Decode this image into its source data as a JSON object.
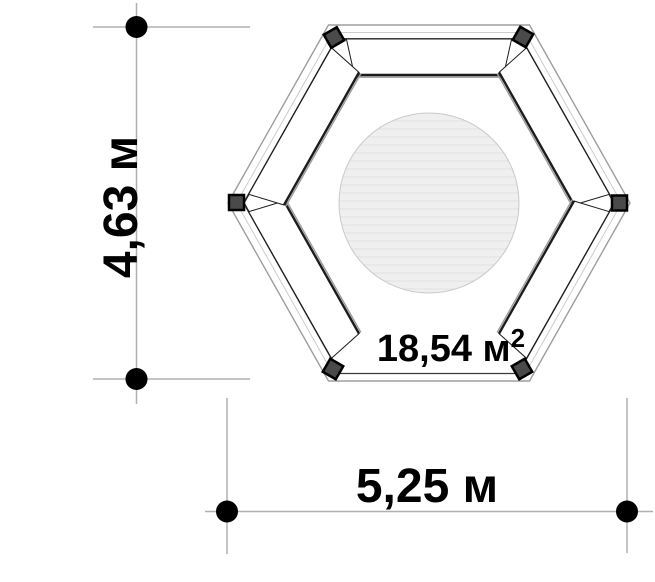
{
  "plan": {
    "dimensions": {
      "vertical": "4,63 м",
      "horizontal": "5,25 м"
    },
    "area": {
      "label": "18,54 м²",
      "base": "18,54 м",
      "superscript": "2"
    }
  },
  "colors": {
    "background": "#ffffff",
    "text": "#000000",
    "dim_line": "#b0b0b0",
    "dim_dot": "#000000",
    "wall_outer": "#9e9e9e",
    "wall_mid": "#cccccc",
    "wall_bottom": "#3a3a3a",
    "wall_inner": "#2a2a2a",
    "bench_line": "#1c1c1c",
    "bench_shadow": "#9c9c9c",
    "post_fill": "#4a4a4a",
    "post_stroke": "#000000",
    "circle_fill": "#efefef",
    "circle_hatch": "#e0e0e0",
    "circle_stroke": "#c9c9c9"
  }
}
